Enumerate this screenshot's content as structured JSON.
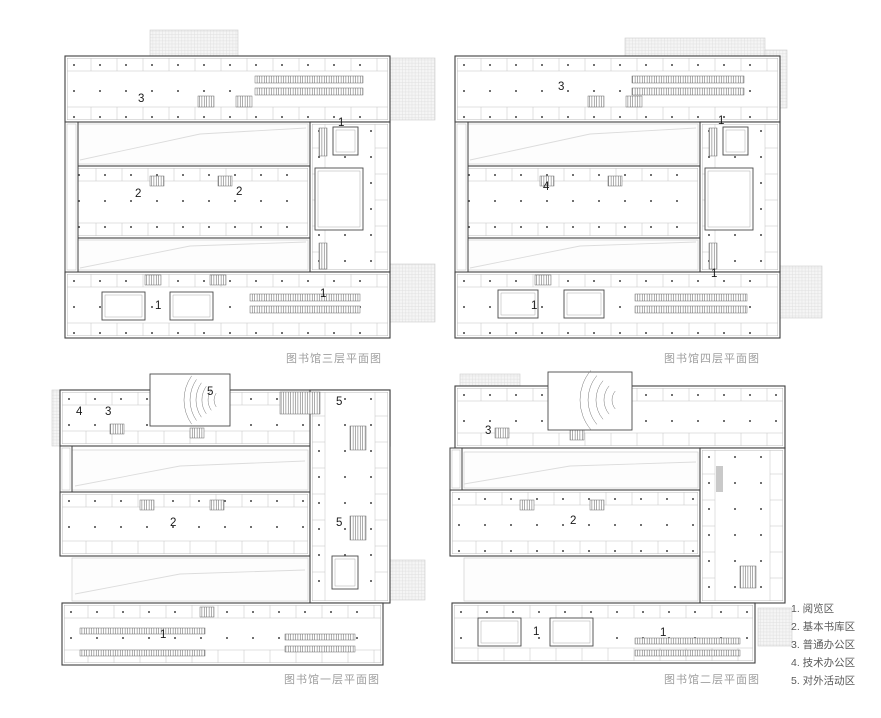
{
  "colors": {
    "wall": "#3f3f3f",
    "wallInner": "#ababab",
    "partition": "#bdbdbd",
    "dot": "#3a3a3a",
    "caption": "#9e9e9e",
    "legendText": "#5a5a5a",
    "terraceLine": "#e0e0e0",
    "terraceBg": "#f5f5f5",
    "terraceBorder": "#cccccc",
    "faint": "#dcdcdc",
    "courtyardLine": "#c4c4c4",
    "hatch": "#5a5a5a",
    "grayFill": "#c9c9c9",
    "zoneLabel": "#1a1a1a",
    "courtLine": "#4a4a4a"
  },
  "legend": {
    "items": [
      "1. 阅览区",
      "2. 基本书库区",
      "3. 普通办公区",
      "4. 技术办公区",
      "5. 对外活动区"
    ]
  },
  "plans": [
    {
      "id": "floor3",
      "caption": "图书馆三层平面图",
      "pos": {
        "x": 50,
        "y": 18
      },
      "bars": [
        [
          15,
          38,
          325,
          66,
          "h"
        ],
        [
          20,
          148,
          240,
          72,
          "h"
        ],
        [
          260,
          104,
          80,
          150,
          "v"
        ],
        [
          15,
          254,
          325,
          66,
          "h"
        ]
      ],
      "strips": [
        [
          15,
          104,
          13,
          150
        ]
      ],
      "courtyards": [
        [
          28,
          106,
          230,
          40
        ],
        [
          28,
          222,
          230,
          30
        ]
      ],
      "diags": [
        [
          [
            30,
            142
          ],
          [
            150,
            116
          ],
          [
            256,
            110
          ]
        ],
        [
          [
            30,
            250
          ],
          [
            140,
            228
          ],
          [
            256,
            224
          ]
        ]
      ],
      "courts": [
        [
          265,
          150,
          48,
          62
        ],
        [
          283,
          109,
          25,
          28
        ],
        [
          52,
          274,
          43,
          28
        ],
        [
          120,
          274,
          43,
          28
        ]
      ],
      "stripes": [
        [
          205,
          58,
          108,
          7
        ],
        [
          205,
          70,
          108,
          7
        ],
        [
          148,
          78,
          16,
          11
        ],
        [
          186,
          78,
          16,
          11
        ],
        [
          100,
          158,
          14,
          10
        ],
        [
          168,
          158,
          14,
          10
        ],
        [
          95,
          257,
          16,
          10
        ],
        [
          160,
          257,
          16,
          10
        ],
        [
          200,
          276,
          110,
          7
        ],
        [
          200,
          288,
          110,
          7
        ],
        [
          269,
          110,
          8,
          28
        ],
        [
          269,
          225,
          8,
          26
        ]
      ],
      "terraces": [
        [
          100,
          12,
          88,
          26
        ],
        [
          340,
          40,
          45,
          62
        ],
        [
          340,
          246,
          45,
          58
        ]
      ],
      "grays": [],
      "fan": null,
      "labels": [
        {
          "t": "3",
          "x": 88,
          "y": 84
        },
        {
          "t": "1",
          "x": 288,
          "y": 108
        },
        {
          "t": "2",
          "x": 85,
          "y": 179
        },
        {
          "t": "2",
          "x": 186,
          "y": 177
        },
        {
          "t": "1",
          "x": 105,
          "y": 291
        },
        {
          "t": "1",
          "x": 270,
          "y": 279
        }
      ]
    },
    {
      "id": "floor4",
      "caption": "图书馆四层平面图",
      "pos": {
        "x": 440,
        "y": 18
      },
      "bars": [
        [
          15,
          38,
          325,
          66,
          "h"
        ],
        [
          20,
          148,
          240,
          72,
          "h"
        ],
        [
          260,
          104,
          80,
          150,
          "v"
        ],
        [
          15,
          254,
          325,
          66,
          "h"
        ]
      ],
      "strips": [
        [
          15,
          104,
          13,
          150
        ]
      ],
      "courtyards": [
        [
          28,
          106,
          230,
          40
        ],
        [
          28,
          222,
          230,
          30
        ]
      ],
      "diags": [
        [
          [
            30,
            142
          ],
          [
            150,
            116
          ],
          [
            256,
            110
          ]
        ],
        [
          [
            30,
            250
          ],
          [
            140,
            228
          ],
          [
            256,
            224
          ]
        ]
      ],
      "courts": [
        [
          265,
          150,
          48,
          62
        ],
        [
          283,
          109,
          25,
          28
        ],
        [
          58,
          272,
          40,
          28
        ],
        [
          124,
          272,
          40,
          28
        ]
      ],
      "stripes": [
        [
          192,
          58,
          112,
          7
        ],
        [
          192,
          70,
          112,
          7
        ],
        [
          148,
          78,
          16,
          11
        ],
        [
          186,
          78,
          16,
          11
        ],
        [
          100,
          158,
          14,
          10
        ],
        [
          168,
          158,
          14,
          10
        ],
        [
          95,
          257,
          16,
          10
        ],
        [
          195,
          276,
          112,
          7
        ],
        [
          195,
          288,
          112,
          7
        ],
        [
          269,
          110,
          8,
          28
        ],
        [
          269,
          225,
          8,
          26
        ]
      ],
      "terraces": [
        [
          185,
          20,
          140,
          20
        ],
        [
          325,
          32,
          22,
          58
        ],
        [
          340,
          248,
          42,
          52
        ]
      ],
      "grays": [],
      "fan": null,
      "labels": [
        {
          "t": "3",
          "x": 118,
          "y": 72
        },
        {
          "t": "1",
          "x": 278,
          "y": 106
        },
        {
          "t": "4",
          "x": 103,
          "y": 172
        },
        {
          "t": "1",
          "x": 91,
          "y": 291
        },
        {
          "t": "1",
          "x": 271,
          "y": 259
        }
      ]
    },
    {
      "id": "floor1",
      "caption": "图书馆一层平面图",
      "pos": {
        "x": 50,
        "y": 366
      },
      "bars": [
        [
          10,
          24,
          330,
          56,
          "h"
        ],
        [
          10,
          126,
          250,
          64,
          "h"
        ],
        [
          260,
          24,
          80,
          213,
          "v"
        ],
        [
          12,
          237,
          321,
          62,
          "h"
        ]
      ],
      "strips": [
        [
          10,
          80,
          12,
          46
        ]
      ],
      "courtyards": [
        [
          22,
          84,
          236,
          40
        ],
        [
          22,
          192,
          236,
          43
        ]
      ],
      "diags": [
        [
          [
            25,
            120
          ],
          [
            130,
            100
          ],
          [
            255,
            95
          ]
        ],
        [
          [
            25,
            228
          ],
          [
            130,
            208
          ],
          [
            255,
            204
          ]
        ]
      ],
      "courts": [
        [
          282,
          190,
          26,
          33
        ]
      ],
      "stripes": [
        [
          230,
          26,
          40,
          22
        ],
        [
          30,
          262,
          125,
          6
        ],
        [
          30,
          284,
          125,
          6
        ],
        [
          235,
          268,
          70,
          6
        ],
        [
          235,
          280,
          70,
          6
        ],
        [
          60,
          58,
          14,
          10
        ],
        [
          140,
          62,
          14,
          10
        ],
        [
          90,
          134,
          14,
          10
        ],
        [
          160,
          134,
          14,
          10
        ],
        [
          150,
          241,
          14,
          10
        ],
        [
          300,
          60,
          16,
          24
        ],
        [
          300,
          150,
          16,
          24
        ]
      ],
      "terraces": [
        [
          2,
          24,
          8,
          56
        ],
        [
          340,
          194,
          35,
          40
        ]
      ],
      "grays": [],
      "fan": {
        "box": [
          100,
          8,
          80,
          52
        ],
        "cx": 176,
        "cy": 34,
        "radii": [
          12,
          18,
          24,
          30,
          36,
          42
        ],
        "a0": 145,
        "a1": 215
      },
      "labels": [
        {
          "t": "4",
          "x": 26,
          "y": 49
        },
        {
          "t": "3",
          "x": 55,
          "y": 49
        },
        {
          "t": "5",
          "x": 157,
          "y": 29
        },
        {
          "t": "5",
          "x": 286,
          "y": 39
        },
        {
          "t": "2",
          "x": 120,
          "y": 160
        },
        {
          "t": "5",
          "x": 286,
          "y": 160
        },
        {
          "t": "1",
          "x": 110,
          "y": 272
        }
      ]
    },
    {
      "id": "floor2",
      "caption": "图书馆二层平面图",
      "pos": {
        "x": 440,
        "y": 366
      },
      "bars": [
        [
          15,
          20,
          330,
          62,
          "h"
        ],
        [
          10,
          124,
          250,
          66,
          "h"
        ],
        [
          260,
          82,
          85,
          155,
          "v"
        ],
        [
          12,
          237,
          303,
          60,
          "h"
        ]
      ],
      "strips": [
        [
          10,
          82,
          12,
          42
        ]
      ],
      "courtyards": [
        [
          24,
          86,
          234,
          36
        ],
        [
          24,
          192,
          234,
          43
        ]
      ],
      "diags": [
        [
          [
            290,
            128
          ],
          [
            322,
            196
          ]
        ],
        [
          [
            24,
            118
          ],
          [
            130,
            100
          ],
          [
            256,
            96
          ]
        ],
        [
          [
            170,
            260
          ],
          [
            230,
            250
          ]
        ]
      ],
      "courts": [
        [
          38,
          252,
          43,
          28
        ],
        [
          110,
          252,
          43,
          28
        ]
      ],
      "stripes": [
        [
          195,
          272,
          105,
          6
        ],
        [
          195,
          284,
          105,
          6
        ],
        [
          55,
          62,
          14,
          10
        ],
        [
          130,
          64,
          14,
          10
        ],
        [
          80,
          134,
          14,
          10
        ],
        [
          150,
          134,
          14,
          10
        ],
        [
          300,
          200,
          16,
          22
        ]
      ],
      "terraces": [
        [
          20,
          8,
          60,
          12
        ],
        [
          318,
          242,
          34,
          38
        ]
      ],
      "grays": [
        [
          276,
          100,
          7,
          26
        ]
      ],
      "fan": {
        "box": [
          108,
          6,
          84,
          58
        ],
        "cx": 186,
        "cy": 34,
        "radii": [
          14,
          22,
          30,
          38,
          46
        ],
        "a0": 140,
        "a1": 220
      },
      "labels": [
        {
          "t": "3",
          "x": 45,
          "y": 68
        },
        {
          "t": "2",
          "x": 130,
          "y": 158
        },
        {
          "t": "1",
          "x": 93,
          "y": 269
        },
        {
          "t": "1",
          "x": 220,
          "y": 270
        }
      ]
    }
  ],
  "captions": {
    "floor3": "图书馆三层平面图",
    "floor4": "图书馆四层平面图",
    "floor1": "图书馆一层平面图",
    "floor2": "图书馆二层平面图"
  }
}
